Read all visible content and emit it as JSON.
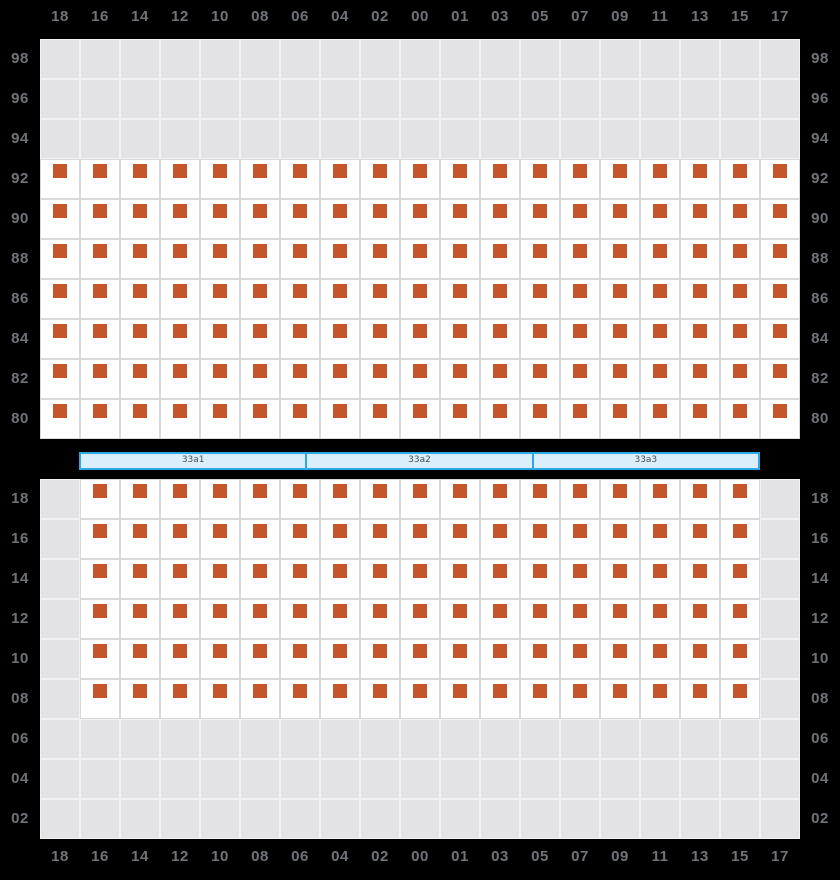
{
  "colors": {
    "background": "#000000",
    "seat": "#C4562C",
    "empty_cell": "#E3E3E5",
    "empty_cell_line": "#F2F2F4",
    "seat_cell": "#FFFFFF",
    "seat_cell_line": "#D9D9DB",
    "axis_label": "#70747A",
    "bar_fill": "#DBEEFB",
    "bar_border": "#2EA7E6",
    "bar_text": "#4A4E53"
  },
  "columns": [
    "18",
    "16",
    "14",
    "12",
    "10",
    "08",
    "06",
    "04",
    "02",
    "00",
    "01",
    "03",
    "05",
    "07",
    "09",
    "11",
    "13",
    "15",
    "17"
  ],
  "upper_grid": {
    "rows": [
      {
        "label": "98",
        "seats": "none"
      },
      {
        "label": "96",
        "seats": "none"
      },
      {
        "label": "94",
        "seats": "none"
      },
      {
        "label": "92",
        "seats": "all"
      },
      {
        "label": "90",
        "seats": "all"
      },
      {
        "label": "88",
        "seats": "all"
      },
      {
        "label": "86",
        "seats": "all"
      },
      {
        "label": "84",
        "seats": "all"
      },
      {
        "label": "82",
        "seats": "all"
      },
      {
        "label": "80",
        "seats": "all"
      }
    ]
  },
  "section_bar": {
    "segments": [
      {
        "label": "33a1"
      },
      {
        "label": "33a2"
      },
      {
        "label": "33a3"
      }
    ]
  },
  "lower_grid": {
    "rows": [
      {
        "label": "18",
        "seats": "inner"
      },
      {
        "label": "16",
        "seats": "inner"
      },
      {
        "label": "14",
        "seats": "inner"
      },
      {
        "label": "12",
        "seats": "inner"
      },
      {
        "label": "10",
        "seats": "inner"
      },
      {
        "label": "08",
        "seats": "inner"
      },
      {
        "label": "06",
        "seats": "none"
      },
      {
        "label": "04",
        "seats": "none"
      },
      {
        "label": "02",
        "seats": "none"
      }
    ]
  }
}
